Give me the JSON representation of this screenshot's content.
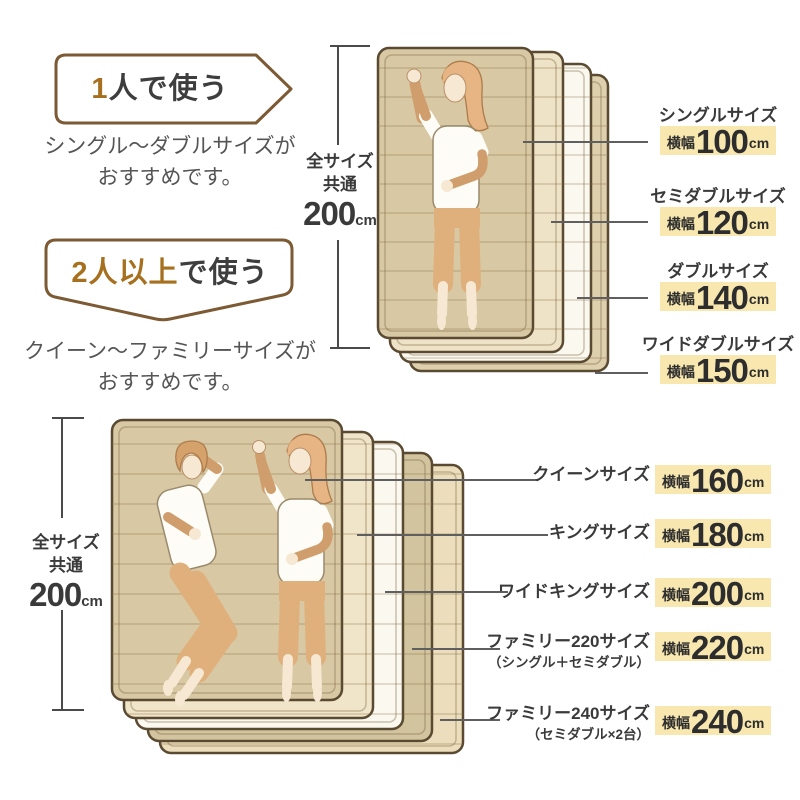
{
  "palette": {
    "badge_border": "#7c5a34",
    "accent_text": "#a7701e",
    "dark_text": "#3e3e3e",
    "subtitle_text": "#555555",
    "highlight_bg": "#f8e8b0",
    "leader_line": "#5f5f5f",
    "mattress_border": "#5a4a31",
    "mattress_tan": "#d8c8a4",
    "mattress_cream": "#eee3c6",
    "mattress_white": "#fbf8ef"
  },
  "single": {
    "badge": {
      "accent": "1",
      "rest": "人で使う"
    },
    "subtitle1": "シングル〜ダブルサイズが",
    "subtitle2": "おすすめです。",
    "measure": {
      "label1": "全サイズ",
      "label2": "共通",
      "number": "200",
      "unit": "cm"
    },
    "sizes": [
      {
        "name": "シングルサイズ",
        "prefix": "横幅",
        "value": "100",
        "unit": "cm"
      },
      {
        "name": "セミダブルサイズ",
        "prefix": "横幅",
        "value": "120",
        "unit": "cm"
      },
      {
        "name": "ダブルサイズ",
        "prefix": "横幅",
        "value": "140",
        "unit": "cm"
      },
      {
        "name": "ワイドダブルサイズ",
        "prefix": "横幅",
        "value": "150",
        "unit": "cm"
      }
    ]
  },
  "double": {
    "badge": {
      "accent": "2人以上",
      "rest": "で使う"
    },
    "subtitle1": "クイーン〜ファミリーサイズが",
    "subtitle2": "おすすめです。",
    "measure": {
      "label1": "全サイズ",
      "label2": "共通",
      "number": "200",
      "unit": "cm"
    },
    "sizes": [
      {
        "name": "クイーンサイズ",
        "sub": "",
        "prefix": "横幅",
        "value": "160",
        "unit": "cm"
      },
      {
        "name": "キングサイズ",
        "sub": "",
        "prefix": "横幅",
        "value": "180",
        "unit": "cm"
      },
      {
        "name": "ワイドキングサイズ",
        "sub": "",
        "prefix": "横幅",
        "value": "200",
        "unit": "cm"
      },
      {
        "name": "ファミリー220サイズ",
        "sub": "（シングル＋セミダブル）",
        "prefix": "横幅",
        "value": "220",
        "unit": "cm"
      },
      {
        "name": "ファミリー240サイズ",
        "sub": "（セミダブル×2台）",
        "prefix": "横幅",
        "value": "240",
        "unit": "cm"
      }
    ]
  }
}
